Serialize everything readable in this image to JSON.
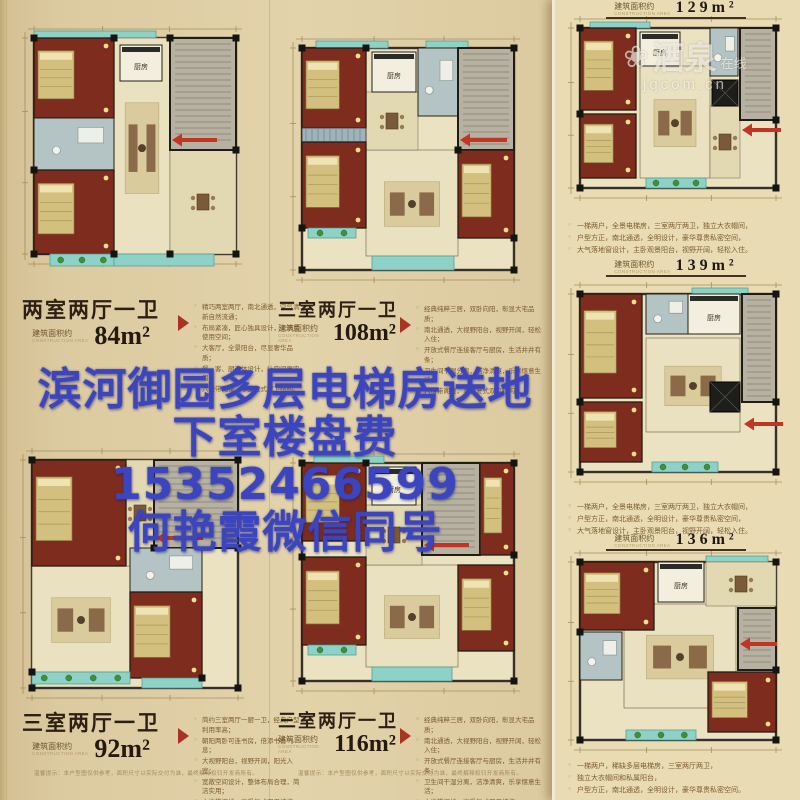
{
  "watermark": {
    "logo": "❀",
    "brand": "酒泉",
    "suffix": "在线",
    "domain": "jqcom.cn"
  },
  "overlay": {
    "line1": "滨河御园多层电梯房送地",
    "line2": "下室楼盘费15352466599",
    "line3": "何艳霞微信同号"
  },
  "labels": {
    "area_prefix": "建筑面积约",
    "area_prefix_sub": "CONSTRUCTION AREA",
    "kitchen": "厨房"
  },
  "disclaimer": "温馨提示：本户型图仅供参考，面积尺寸以实际交付为准，最终解释权归开发商所有。",
  "colors": {
    "overlay_blue": "#3c45bd",
    "accent_red": "#a83524",
    "bedroom_red": "#7d2c1e",
    "balcony_teal": "#8ed1c6",
    "paper_tan": "#e3d3ab"
  },
  "plans": [
    {
      "title": "两室两厅一卫",
      "area": "84m²",
      "bullets": [
        "精巧两室两厅，南北通透，空气清新自然流通；",
        "布局紧凑，匠心独具设计，无浪费使用空间；",
        "大客厅，全景阳台，尽显奢华品质；",
        "餐、客、厨连体设计，让空间更实用；",
        "六楼带阁楼，享受复式双卫结构。"
      ]
    },
    {
      "title": "三室两厅一卫",
      "area": "108m²",
      "bullets": [
        "经典纯粹三居，双卧向阳，彰显大宅品质；",
        "南北通透，大视野阳台，视野开阔，轻松入住；",
        "开放式餐厅连接客厅与厨房，生活井井有条；",
        "卫生间干湿分离，洁净清爽，乐享惬意生活；",
        "六楼带阁楼，享受复式双卫结构。"
      ]
    },
    {
      "title": "三室两厅一卫",
      "area": "92m²",
      "bullets": [
        "简约三室两厅一厨一卫，经典户型利用率高；",
        "朝阳两卧可连书房，倍添书香气息；",
        "大视野阳台，视野开阔，阳光入室；",
        "宽敞空间设计，整体布局合理，简洁实用；",
        "六楼带阁楼，享受复式双卫结构。"
      ]
    },
    {
      "title": "三室两厅一卫",
      "area": "116m²",
      "bullets": [
        "经典纯粹三居，双卧向阳，彰显大宅品质；",
        "南北通透，大视野阳台，视野开阔，轻松入住；",
        "开放式餐厅连接客厅与厨房，生活井井有条；",
        "卫生间干湿分离，洁净清爽，乐享惬意生活；",
        "六楼带阁楼，享受复式双卫结构。"
      ]
    },
    {
      "area": "129m²",
      "bullets": [
        "一梯两户，全景电梯房，三室两厅两卫，独立大衣帽间，",
        "户型方正，南北通透，全明设计，豪华尊贵私密空间，",
        "大气落地窗设计，主卧观景阳台，视野开阔，轻松入住。"
      ]
    },
    {
      "area": "139m²",
      "bullets": [
        "一梯两户，全景电梯房，三室两厅两卫，独立大衣帽间，",
        "户型方正，南北通透，全明设计，豪华尊贵私密空间，",
        "大气落地窗设计，主卧观景阳台，视野开阔，轻松入住。"
      ]
    },
    {
      "area": "136m²",
      "bullets": [
        "一梯两户，稀缺多层电梯房，三室两厅两卫，",
        "独立大衣帽间和私属阳台，",
        "户型方正，南北通透，全明设计，豪华尊贵私密空间。"
      ]
    }
  ]
}
